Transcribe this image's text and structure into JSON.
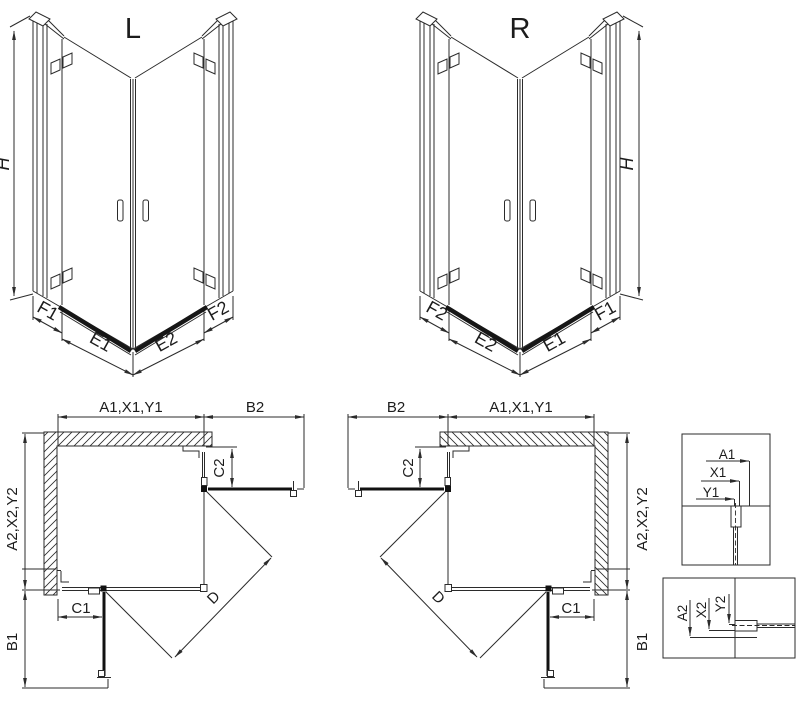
{
  "page": {
    "background": "#ffffff",
    "line_color": "#2b2b2b",
    "thick_line_color": "#111111"
  },
  "views": {
    "front_left": {
      "title": "L",
      "height_label": "H",
      "bottom_labels": [
        "F1",
        "E1",
        "E2",
        "F2"
      ]
    },
    "front_right": {
      "title": "R",
      "height_label": "H",
      "bottom_labels": [
        "F2",
        "E2",
        "E1",
        "F1"
      ]
    },
    "plan_left": {
      "top_width_label": "A1,X1,Y1",
      "open_door_top_label": "B2",
      "fixed_right_label": "C2",
      "fixed_bottom_label": "C1",
      "side_depth_label": "A2,X2,Y2",
      "open_door_side_label": "B1",
      "diagonal_label": "D"
    },
    "plan_right": {
      "top_width_label": "A1,X1,Y1",
      "open_door_top_label": "B2",
      "fixed_right_label": "C2",
      "fixed_bottom_label": "C1",
      "side_depth_label": "A2,X2,Y2",
      "open_door_side_label": "B1",
      "diagonal_label": "D"
    },
    "detail_top": {
      "labels": [
        "A1",
        "X1",
        "Y1"
      ]
    },
    "detail_bottom": {
      "labels": [
        "A2",
        "X2",
        "Y2"
      ]
    }
  }
}
